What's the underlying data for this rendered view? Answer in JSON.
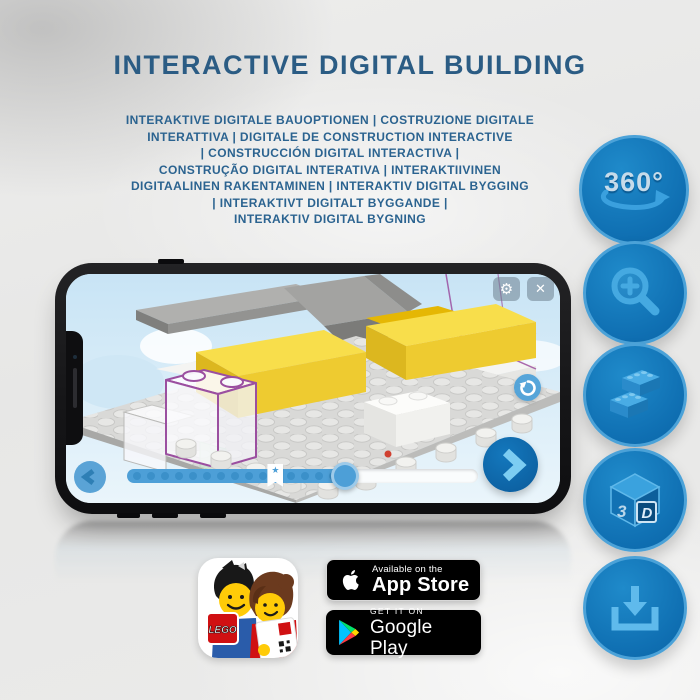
{
  "title": "INTERACTIVE DIGITAL BUILDING",
  "subtitle_lines": [
    "INTERAKTIVE DIGITALE BAUOPTIONEN | COSTRUZIONE DIGITALE",
    "INTERATTIVA | DIGITALE DE CONSTRUCTION INTERACTIVE",
    "| CONSTRUCCIÓN DIGITAL INTERACTIVA |",
    "CONSTRUÇÃO DIGITAL INTERATIVA | INTERAKTIIVINEN",
    "DIGITAALINEN RAKENTAMINEN | INTERAKTIV DIGITAL BYGGING",
    "| INTERAKTIVT DIGITALT BYGGANDE |",
    "INTERAKTIV DIGITAL BYGNING"
  ],
  "feature_buttons": [
    {
      "name": "rotate-360",
      "label": "360°"
    },
    {
      "name": "zoom-in"
    },
    {
      "name": "brick-stack"
    },
    {
      "name": "view-3d",
      "cube_left": "3",
      "cube_right": "D"
    },
    {
      "name": "download"
    }
  ],
  "phone": {
    "app_toolbar": {
      "gear_icon": "⚙",
      "close_icon": "✕"
    },
    "progress": {
      "fill_percent": 62,
      "bookmark_percent": 40,
      "bookmark_star": "★",
      "step_dots": 15
    }
  },
  "store_badges": {
    "app_store": {
      "line1": "Available on the",
      "line2": "App Store"
    },
    "google_play": {
      "line1": "GET IT ON",
      "line2": "Google Play"
    },
    "app_icon_logo": "LEGO"
  },
  "colors": {
    "title_blue": "#2b5c84",
    "circle_blue": "#1074b6",
    "icon_light_blue": "#45a9e1",
    "app_accent_blue": "#4d9fd7",
    "lego_yellow": "#f3d43c",
    "lego_red": "#d01012"
  }
}
